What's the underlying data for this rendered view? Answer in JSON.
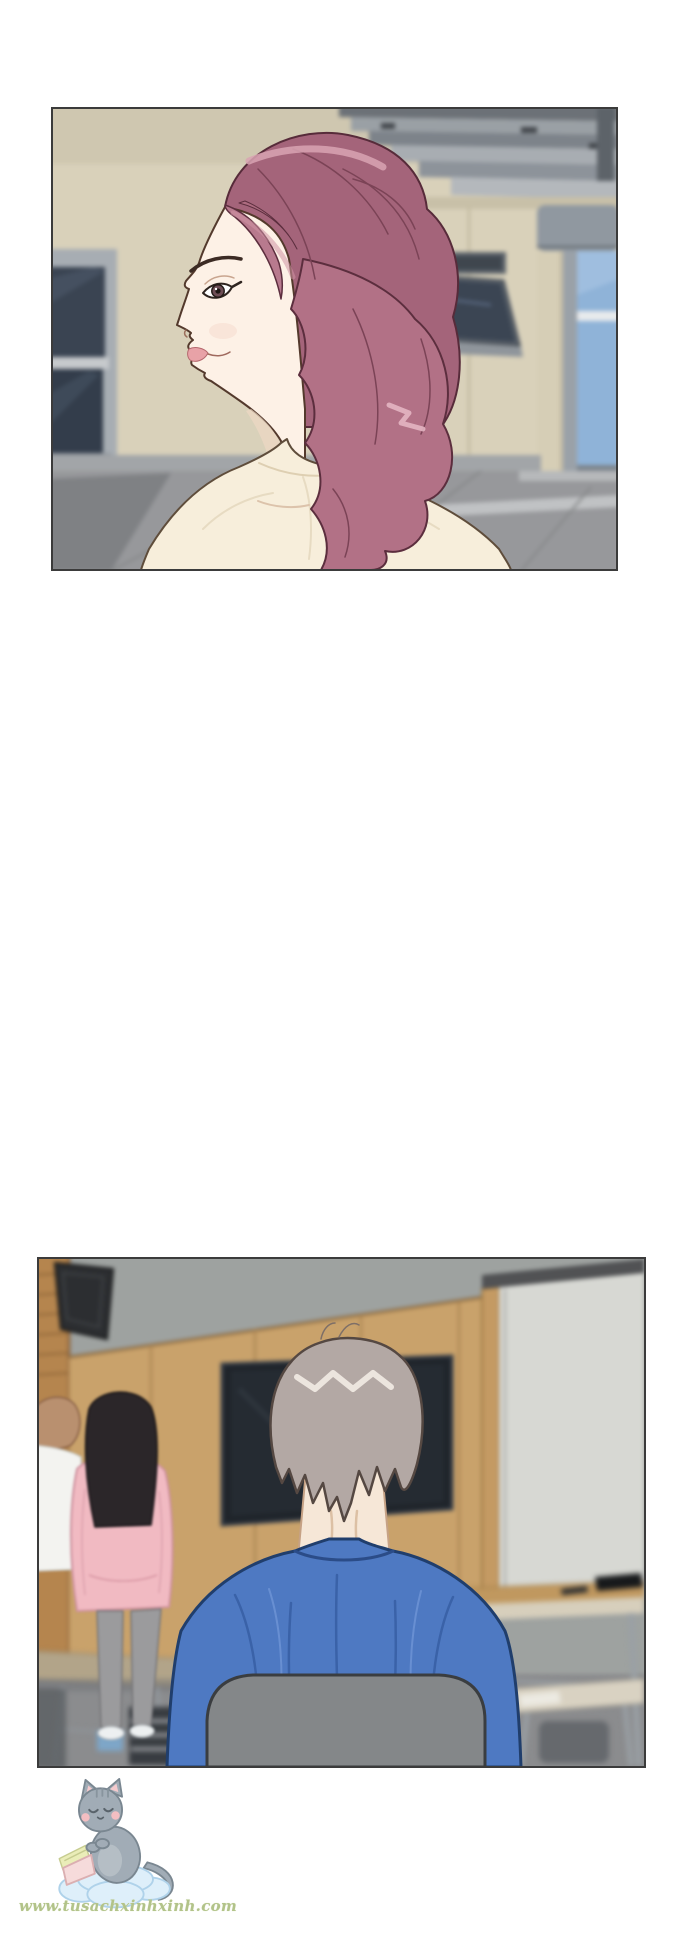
{
  "page": {
    "background_color": "#ffffff",
    "width_px": 690,
    "height_px": 1935,
    "kind_label": "webtoon comic page with two panels"
  },
  "panels": [
    {
      "alt": "Side profile of a woman with wavy mauve-pink hair and a cream top, standing outside a beige building with tinted windows, an open awning window, gray roof slats and a blue glass door",
      "border_color": "#3b3b3b",
      "palette": {
        "wall": "#d9d1ba",
        "roof_slats": "#9aa0a5",
        "window_glass": "#3a4452",
        "door_glass": "#8fb3d8",
        "pavement": "#97989b",
        "hair": "#b27186",
        "hair_highlight": "#d9a3b3",
        "skin": "#fdf1e6",
        "lips": "#e8a2a7",
        "shirt": "#f7eedb"
      }
    },
    {
      "alt": "Back view of a gray-haired man in a blue shirt seated on a gray chair in a classroom; a dark TV hangs on a wood-paneled wall, a whiteboard stands at right, desks at both sides, and two people stand at the left, one in a pink hoodie with long black hair",
      "border_color": "#3b3b3b",
      "palette": {
        "upper_wall": "#9ea2a0",
        "wood_wall": "#c9a26b",
        "speaker": "#2c2e31",
        "tv": "#1f242a",
        "whiteboard": "#d7d8d3",
        "floor": "#8b8c8e",
        "man_hair": "#b3a8a4",
        "man_shirt": "#4e79c2",
        "chair": "#848789",
        "hoodie": "#f1bac2",
        "pants": "#9b9b9d"
      }
    }
  ],
  "watermark": {
    "text": "www.tusachxinhxinh.com",
    "text_color": "#b2c389",
    "mascot_alt": "gray kitten reading a pink book while sitting on a light blue cloud",
    "mascot_colors": {
      "cat_body": "#9aa6b0",
      "cloud": "#dceefa",
      "book_cover": "#f6d8d9",
      "book_pages": "#e9ecb2"
    }
  }
}
